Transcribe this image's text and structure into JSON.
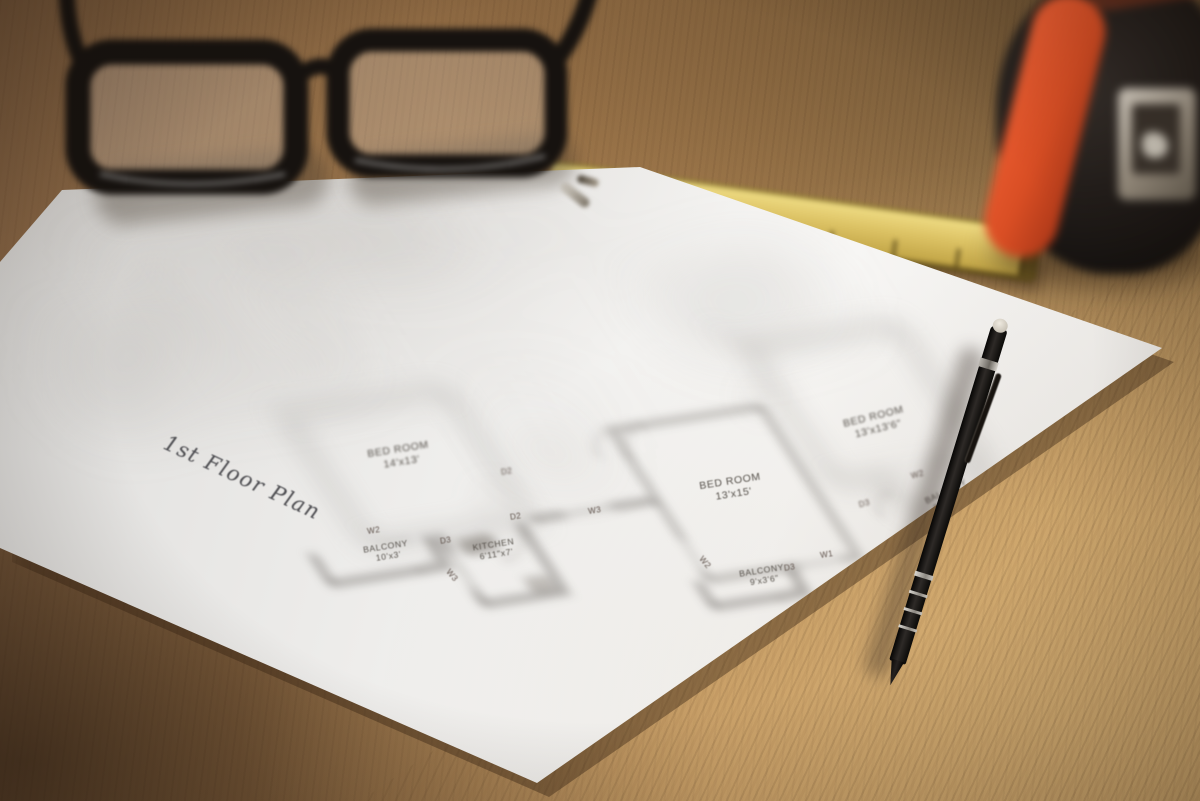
{
  "floor_plan": {
    "title": "1st Floor Plan",
    "rooms": [
      {
        "name": "BED ROOM",
        "dims": "14'x13'"
      },
      {
        "name": "BALCONY",
        "dims": "10'x3'"
      },
      {
        "name": "KITCHEN",
        "dims": "6'11\"x7'"
      },
      {
        "name": "BED ROOM",
        "dims": "13'x15'"
      },
      {
        "name": "BALCONY",
        "dims": "9'x3'6\""
      },
      {
        "name": "BED ROOM",
        "dims": "13'x13'6\""
      },
      {
        "name": "BALCONY",
        "dims": "9'6\"x3'6\""
      }
    ],
    "markers": [
      "D2",
      "D3",
      "W2",
      "W3",
      "D2",
      "W3",
      "W2",
      "D3",
      "W1",
      "D3",
      "W2"
    ]
  },
  "objects": {
    "eyeglasses": {
      "frame_color": "#16120f"
    },
    "folding_ruler": {
      "color": "#dcc264"
    },
    "tape_measure": {
      "body_color": "#1c1815",
      "accent_color": "#e0502a"
    },
    "pen": {
      "body_color": "#0c0a09",
      "ring_color": "#cfcbc4"
    },
    "paper": {
      "color": "#f1f0ee"
    },
    "desk": {
      "wood_color": "#a87e50"
    }
  }
}
